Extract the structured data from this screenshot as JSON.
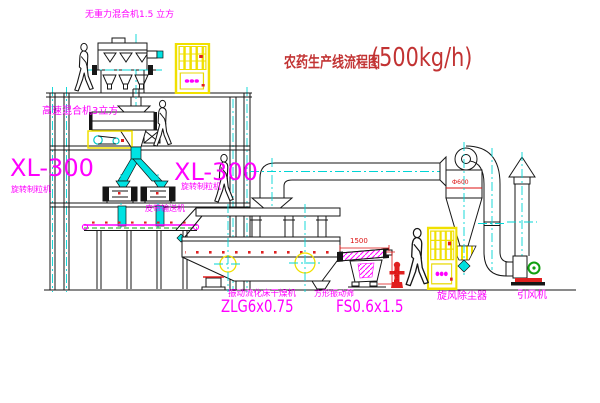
{
  "title": {
    "line": "农药生产线流程图",
    "capacity": "(500kg/h)"
  },
  "equipment_labels": {
    "gravity_mixer": "无重力混合机1.5 立方",
    "high_speed_mixer": "高速混合机3立方",
    "granulator_left": {
      "model": "XL-300",
      "name": "旋转制粒机"
    },
    "granulator_right": {
      "model": "XL-300",
      "name": "旋转制粒机"
    },
    "belt_conveyor": "皮带输送机",
    "fluid_bed_dryer": {
      "name": "振动流化床干燥机",
      "model": "ZLG6x0.75"
    },
    "vibrating_sieve": {
      "name": "方形振动筛",
      "model": "FS0.6x1.5"
    },
    "cyclone": "旋风除尘器",
    "induced_draft_fan": "引风机"
  },
  "dimensions": {
    "sieve_length": "1500",
    "sieve_height": "545",
    "cyclone_diameter": "Ф600"
  },
  "colors": {
    "label_magenta": "#ff00ff",
    "title_red": "#c23333",
    "dimension_red": "#dd1111",
    "centerline_cyan": "#00d5d5",
    "cabinet_yellow": "#f0e000",
    "motor_green": "#10a010"
  }
}
